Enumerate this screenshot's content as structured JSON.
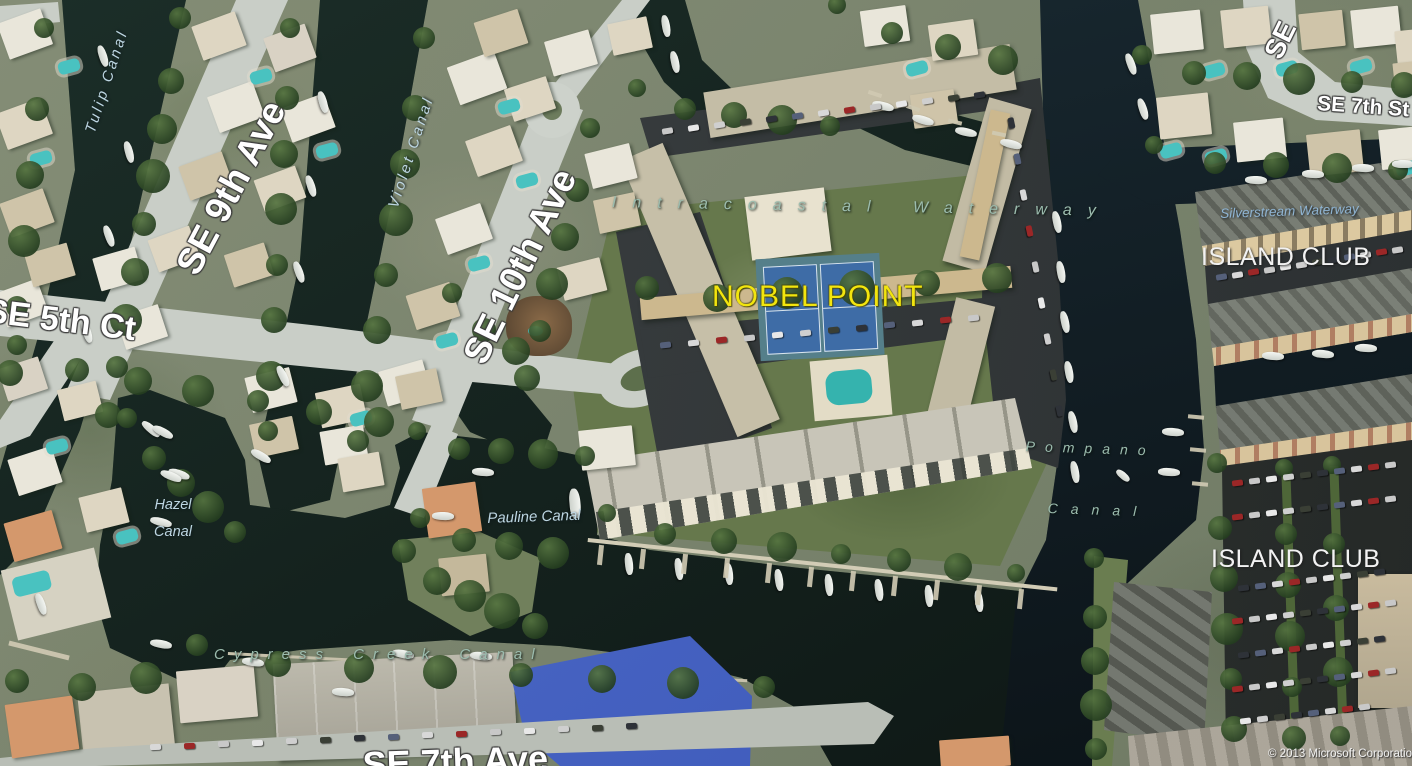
{
  "map": {
    "poi": {
      "nobel_point": "NOBEL POINT"
    },
    "streets": {
      "se_9th_ave": "SE 9th Ave",
      "se_10th_ave": "SE 10th Ave",
      "se_5th_ct": "SE 5th Ct",
      "se_7th_st": "SE 7th St",
      "se_partial": "SE",
      "se_7th_ave": "SE 7th Ave"
    },
    "waterways": {
      "tulip_canal": "Tulip Canal",
      "violet_canal": "Violet Canal",
      "hazel_line1": "Hazel",
      "hazel_line2": "Canal",
      "pauline_canal": "Pauline Canal",
      "intracoastal": "Intracoastal Waterway",
      "silverstream": "Silverstream Waterway",
      "pompano_line1": "Pompano",
      "pompano_line2": "Canal",
      "cypress_creek": "Cypress Creek Canal"
    },
    "places": {
      "island_club_north": "ISLAND CLUB",
      "island_club_south": "ISLAND CLUB"
    },
    "attribution": "© 2013 Microsoft Corporation",
    "colors": {
      "poi_label": "#f2e50e",
      "street_label": "#ffffff",
      "canal_label": "#bdd6e2",
      "waterway_label": "#9cbcae",
      "silverstream_label": "#8fb4d2",
      "place_label": "#f2f2f2",
      "water": "#15231f",
      "waterway_water": "#132028"
    }
  }
}
